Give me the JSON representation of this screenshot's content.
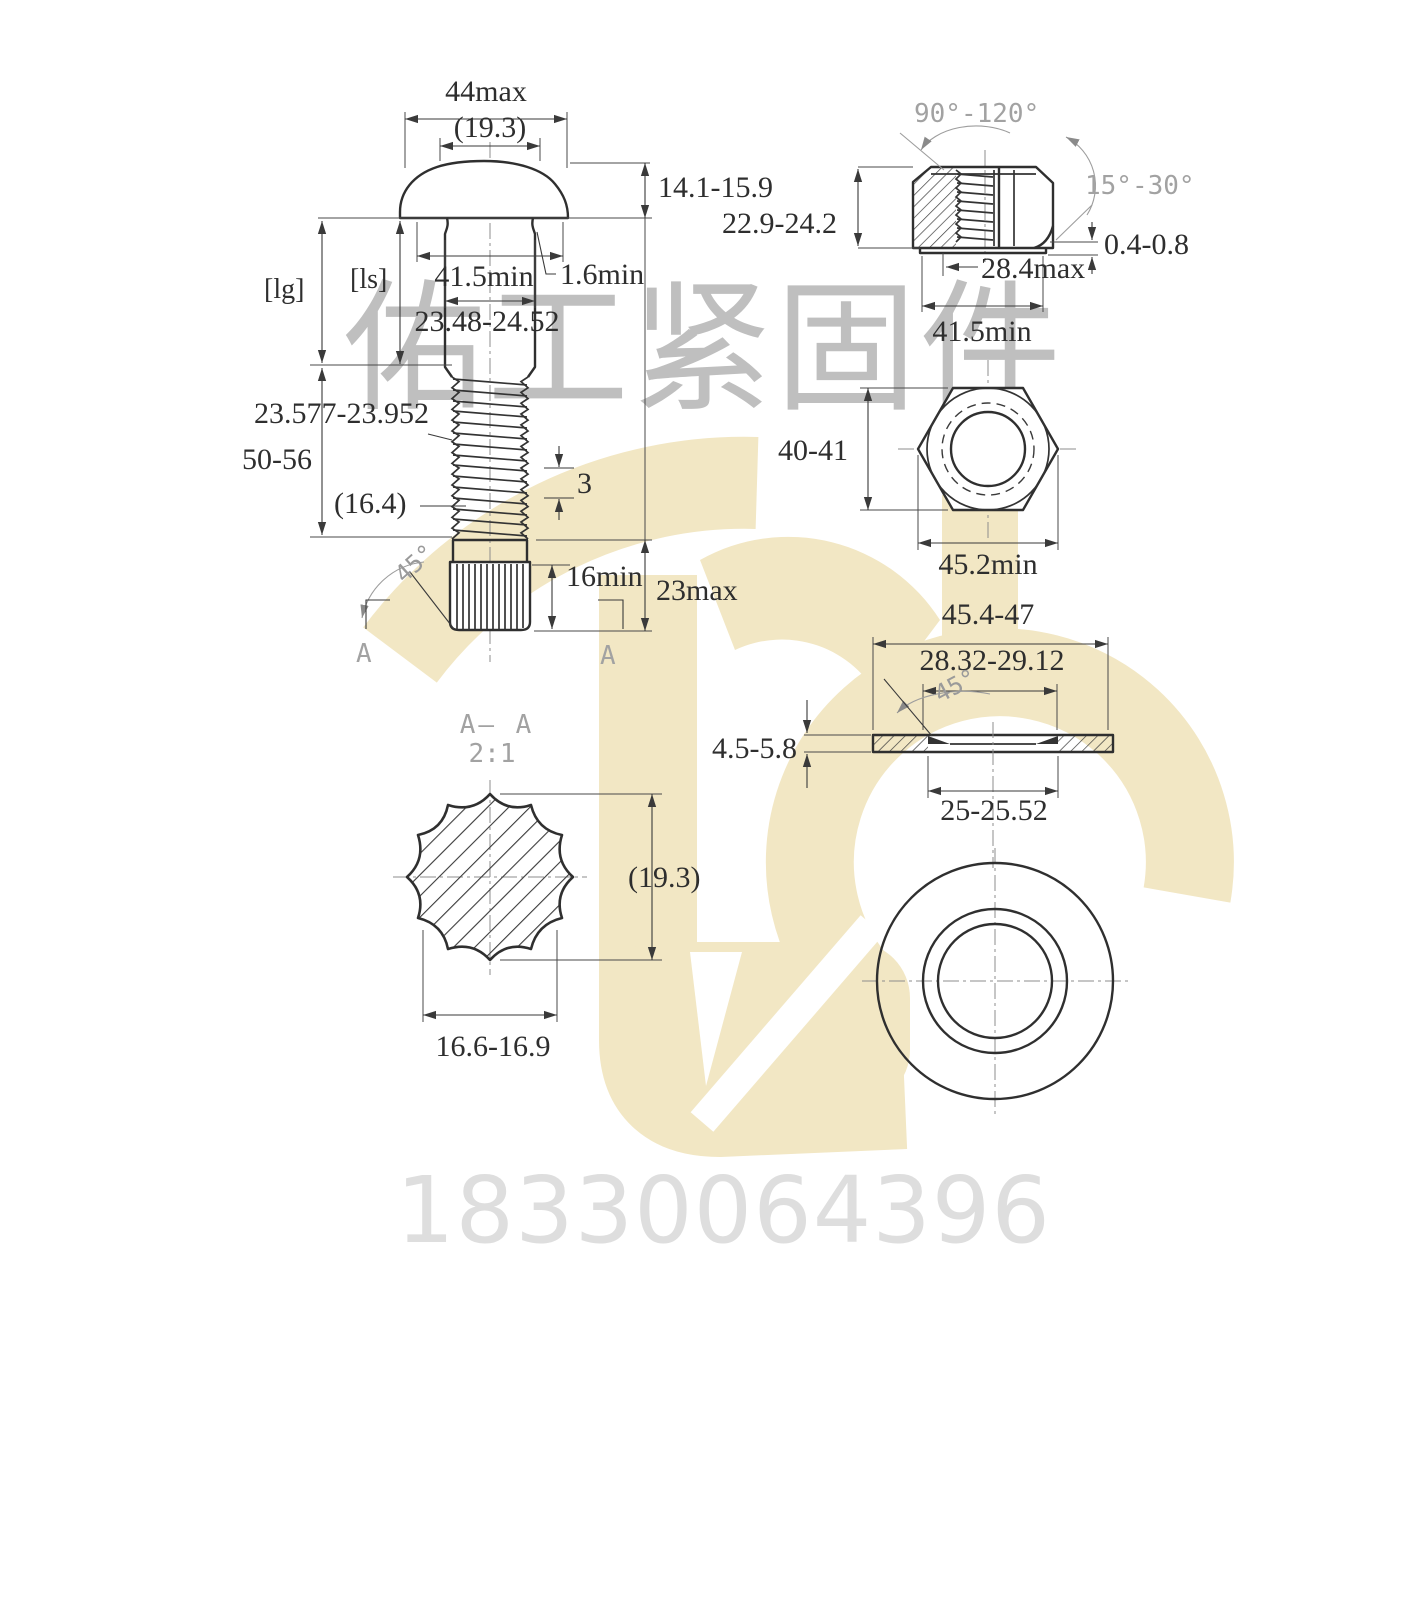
{
  "watermark": {
    "company": "佑工紧固件",
    "phone": "18330064396",
    "logo_color": "#f2e7c4",
    "company_text_color": "#bfbfbf",
    "phone_text_color": "#dedede"
  },
  "colors": {
    "line": "#2f2f2f",
    "dimension": "#3a3a3a",
    "annotation_gray": "#a2a2a2",
    "background": "#ffffff"
  },
  "drawing": {
    "bolt": {
      "head_width": "44max",
      "head_dia_ref": "(19.3)",
      "head_height": "14.1-15.9",
      "grip_label": "[lg]",
      "shank_label": "[ls]",
      "bearing_dia": "41.5min",
      "fillet": "1.6min",
      "shank_dia": "23.48-24.52",
      "thread_dia": "23.577-23.952",
      "thread_length": "50-56",
      "thread_ref": "(16.4)",
      "pitch": "3",
      "chamfer_angle": "45°",
      "spline_min_len": "16min",
      "tip_max_len": "23max",
      "section_a_left": "A",
      "section_a_right": "A"
    },
    "nut_side": {
      "top_angle": "90°-120°",
      "washer_angle": "15°-30°",
      "height": "22.9-24.2",
      "face_height": "0.4-0.8",
      "bore": "28.4max",
      "bearing_dia": "41.5min"
    },
    "nut_top": {
      "across_flats": "40-41",
      "across_corners": "45.2min"
    },
    "washer_side": {
      "outer_dia": "45.4-47",
      "chamfer_dia": "28.32-29.12",
      "chamfer_angle": "45°",
      "thickness": "4.5-5.8",
      "hole_dia": "25-25.52"
    },
    "section": {
      "title": "A— A",
      "scale": "2:1",
      "dia_ref": "(19.3)",
      "across_flats": "16.6-16.9"
    }
  }
}
